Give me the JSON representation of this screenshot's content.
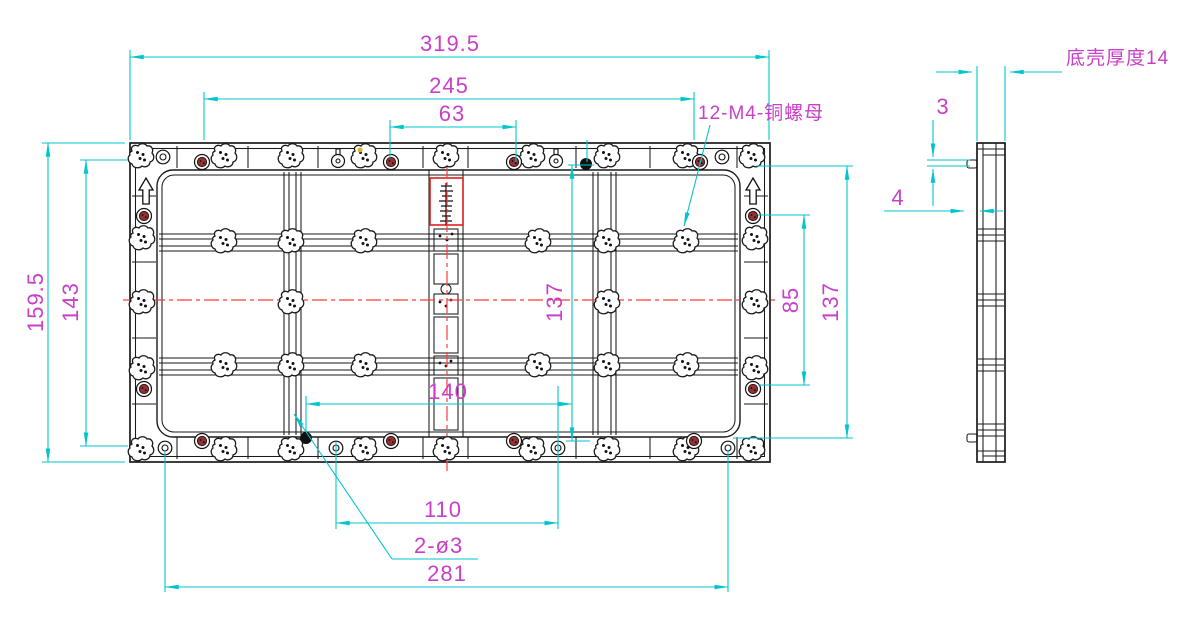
{
  "front_view": {
    "dims_top": {
      "total": "319.5",
      "mid": "245",
      "inner": "63"
    },
    "dims_left": {
      "total": "159.5",
      "inner": "143"
    },
    "dims_middle": {
      "vertical": "137"
    },
    "dims_right": {
      "inner": "85",
      "outer": "137"
    },
    "dims_bottom": {
      "w140": "140",
      "w110": "110",
      "holes": "2-ø3",
      "w281": "281"
    },
    "labels": {
      "nut": "12-M4-铜螺母"
    }
  },
  "side_view": {
    "labels": {
      "thickness": "底壳厚度14"
    },
    "dims": {
      "tab_offset": "3",
      "tab_depth": "4"
    }
  },
  "colors": {
    "dimension_line": "#00c5cd",
    "dimension_text": "#c93fc9",
    "outline": "#1a1a1a",
    "centerline": "#ff3a3a",
    "screw_fill": "#8f3434",
    "highlight_box": "#e02020"
  }
}
